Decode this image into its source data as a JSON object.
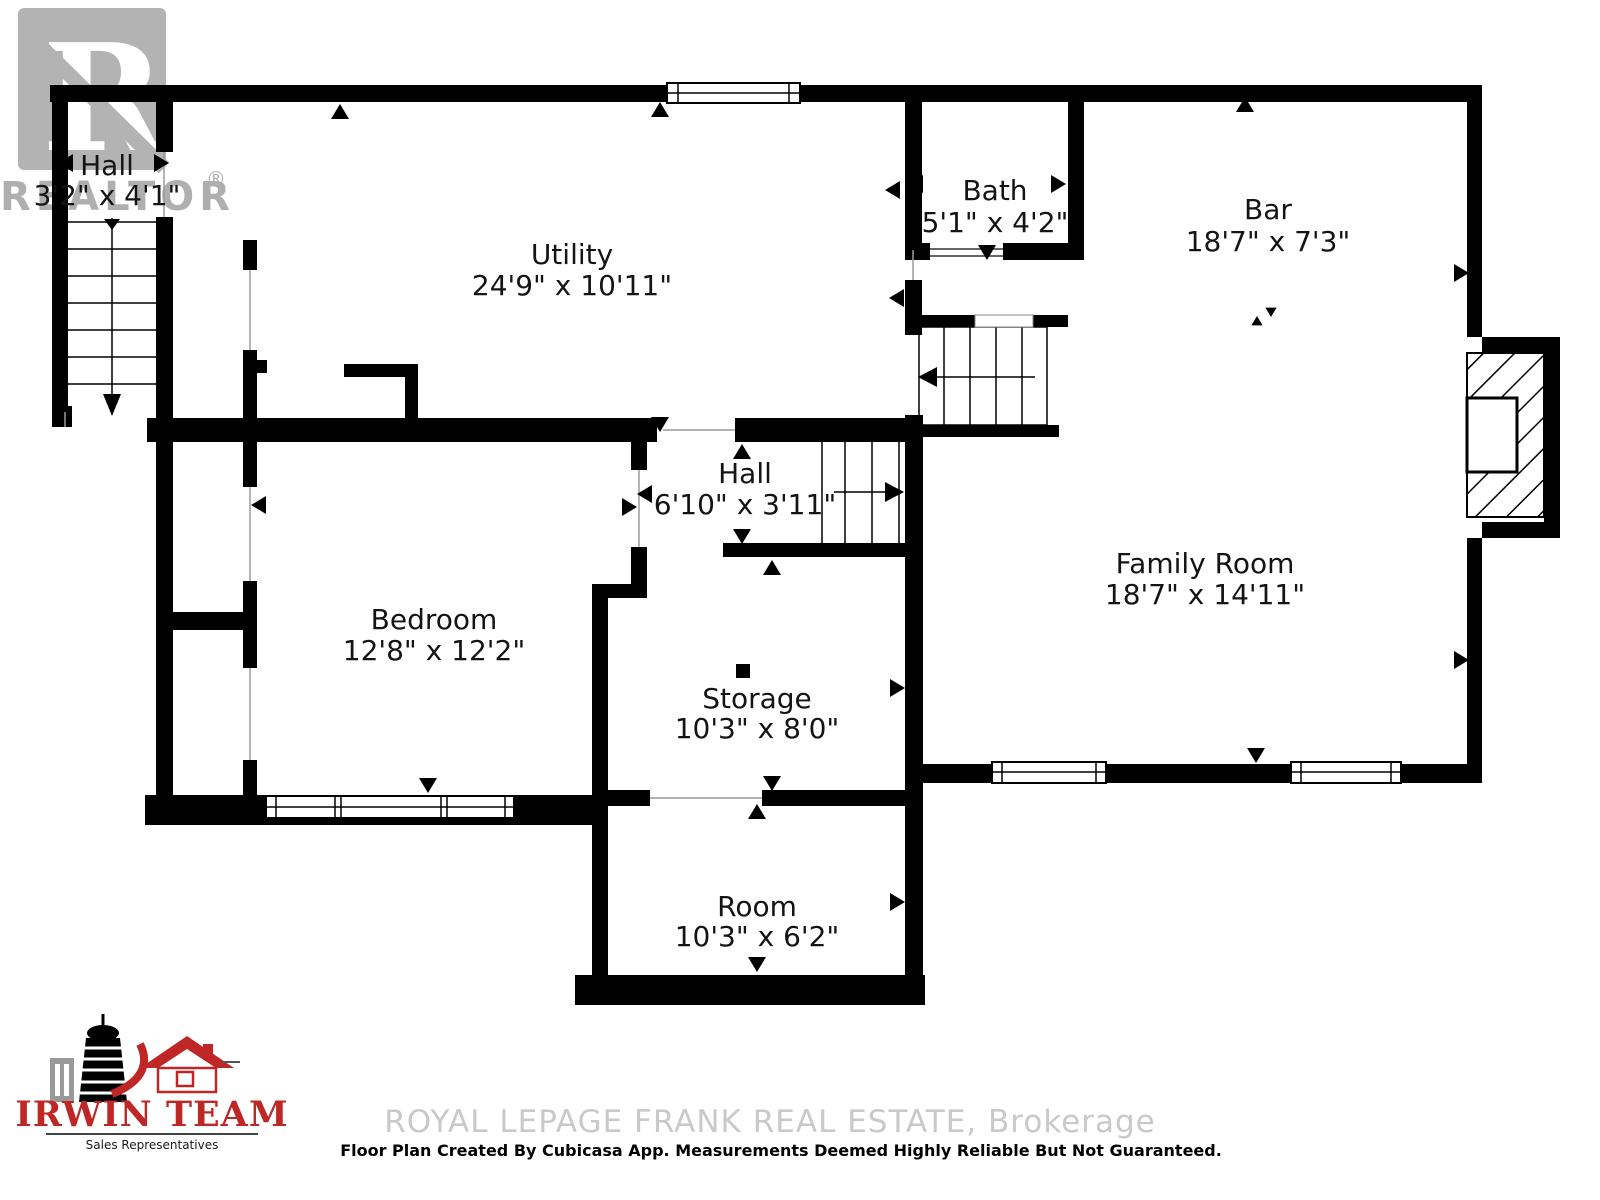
{
  "watermarks": {
    "realtor": {
      "logo_letter": "R",
      "text": "REALTOR",
      "registered": "®",
      "color": "#a2a2a2"
    },
    "brokerage": {
      "text": "ROYAL LEPAGE FRANK REAL ESTATE, Brokerage",
      "color": "#c9c9c9"
    }
  },
  "footer": {
    "disclaimer": "Floor Plan Created By Cubicasa App. Measurements Deemed Highly Reliable But Not Guaranteed."
  },
  "team_logo": {
    "name": "IRWIN TEAM",
    "subtitle": "Sales Representatives",
    "accent_color": "#bf2626"
  },
  "floor_plan": {
    "wall_color": "#000000",
    "rooms": [
      {
        "id": "hall-upper",
        "name": "Hall",
        "dims": "3'2\" x 4'1\""
      },
      {
        "id": "utility",
        "name": "Utility",
        "dims": "24'9\" x 10'11\""
      },
      {
        "id": "bath",
        "name": "Bath",
        "dims": "5'1\" x 4'2\""
      },
      {
        "id": "bar",
        "name": "Bar",
        "dims": "18'7\" x 7'3\""
      },
      {
        "id": "hall-middle",
        "name": "Hall",
        "dims": "6'10\" x 3'11\""
      },
      {
        "id": "family-room",
        "name": "Family Room",
        "dims": "18'7\" x 14'11\""
      },
      {
        "id": "bedroom",
        "name": "Bedroom",
        "dims": "12'8\" x 12'2\""
      },
      {
        "id": "storage",
        "name": "Storage",
        "dims": "10'3\" x 8'0\""
      },
      {
        "id": "room",
        "name": "Room",
        "dims": "10'3\" x 6'2\""
      }
    ]
  }
}
